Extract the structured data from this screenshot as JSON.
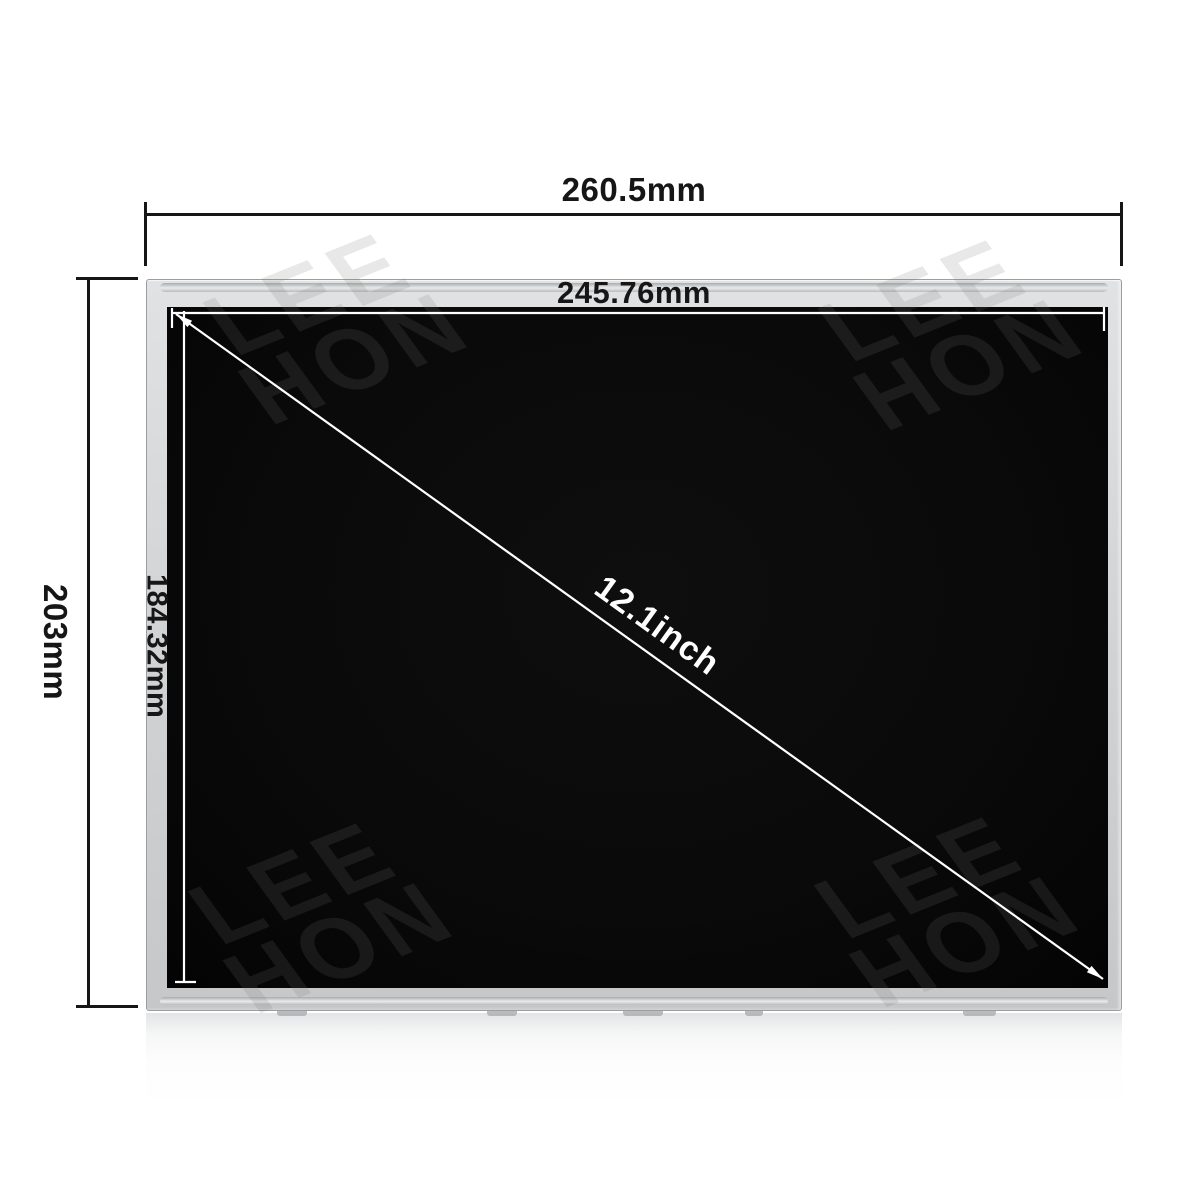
{
  "dimensions": {
    "outer_width": {
      "label": "260.5mm"
    },
    "outer_height": {
      "label": "203mm"
    },
    "active_width": {
      "label": "245.76mm"
    },
    "active_height": {
      "label": "184.32mm"
    },
    "diagonal": {
      "label": "12.1inch"
    }
  },
  "watermark": {
    "line1": "LEE",
    "line2": "HON"
  },
  "colors": {
    "background": "#ffffff",
    "bezel": "#d2d4d6",
    "bezel_edge": "#9b9da0",
    "screen": "#0a0a0a",
    "annotation": "#161616",
    "inner_line": "#ffffff",
    "watermark": "rgba(120,120,120,0.17)"
  }
}
